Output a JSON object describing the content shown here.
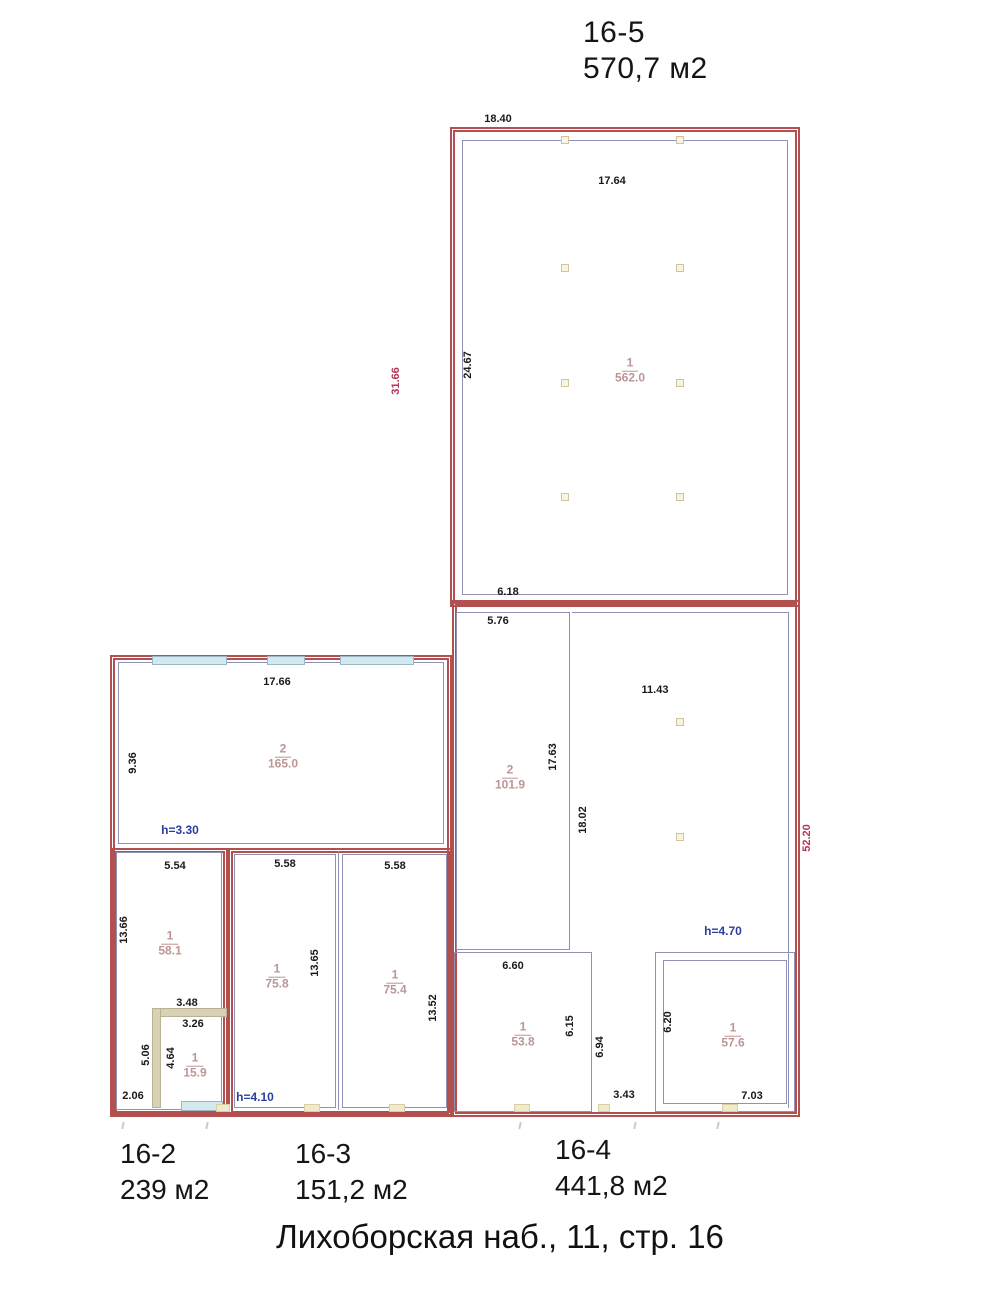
{
  "header": {
    "unit": "16-5",
    "area": "570,7 м2"
  },
  "footer": [
    {
      "unit": "16-2",
      "area": "239 м2"
    },
    {
      "unit": "16-3",
      "area": "151,2 м2"
    },
    {
      "unit": "16-4",
      "area": "441,8 м2"
    }
  ],
  "address": "Лихоборская наб., 11, стр. 16",
  "rooms": {
    "big": {
      "num": "1",
      "area": "562.0"
    },
    "r165": {
      "num": "2",
      "area": "165.0"
    },
    "r58": {
      "num": "1",
      "area": "58.1"
    },
    "r15": {
      "num": "1",
      "area": "15.9"
    },
    "r75a": {
      "num": "1",
      "area": "75.8"
    },
    "r75b": {
      "num": "1",
      "area": "75.4"
    },
    "r101": {
      "num": "2",
      "area": "101.9"
    },
    "r53": {
      "num": "1",
      "area": "53.8"
    },
    "r57": {
      "num": "1",
      "area": "57.6"
    }
  },
  "dims": {
    "top_width": "18.40",
    "inner_top": "17.64",
    "big_left_inner": "24.67",
    "big_left_outer": "31.66",
    "big_bottom": "6.18",
    "r101_top": "5.76",
    "hall_width": "11.43",
    "r101_right": "17.63",
    "corridor_v": "18.02",
    "right_outer": "52.20",
    "r53_top": "6.60",
    "r53_right": "6.15",
    "corridor2_v": "6.94",
    "bottom_corr": "3.43",
    "r57_left": "6.20",
    "r57_bottom": "7.03",
    "r165_top": "17.66",
    "r165_left": "9.36",
    "r58_top": "5.54",
    "r58_left": "13.66",
    "r15_top": "3.48",
    "r15_top2": "3.26",
    "r15_left": "5.06",
    "r15_left2": "4.64",
    "r58_bottom": "2.06",
    "r75a_top": "5.58",
    "r75b_top": "5.58",
    "r75_mid": "13.65",
    "r75b_right": "13.52"
  },
  "heights": {
    "room165": "h=3.30",
    "room75": "h=4.10",
    "hall": "h=4.70"
  },
  "colors": {
    "wall": "#b25050",
    "thin": "#9191b5",
    "rlabel": "#bc9595",
    "dimc": "#1a1a1a",
    "dimred": "#b23557",
    "hblue": "#2b3f9e",
    "cyan": "#d2eaee",
    "beige": "#d9d1b6"
  }
}
